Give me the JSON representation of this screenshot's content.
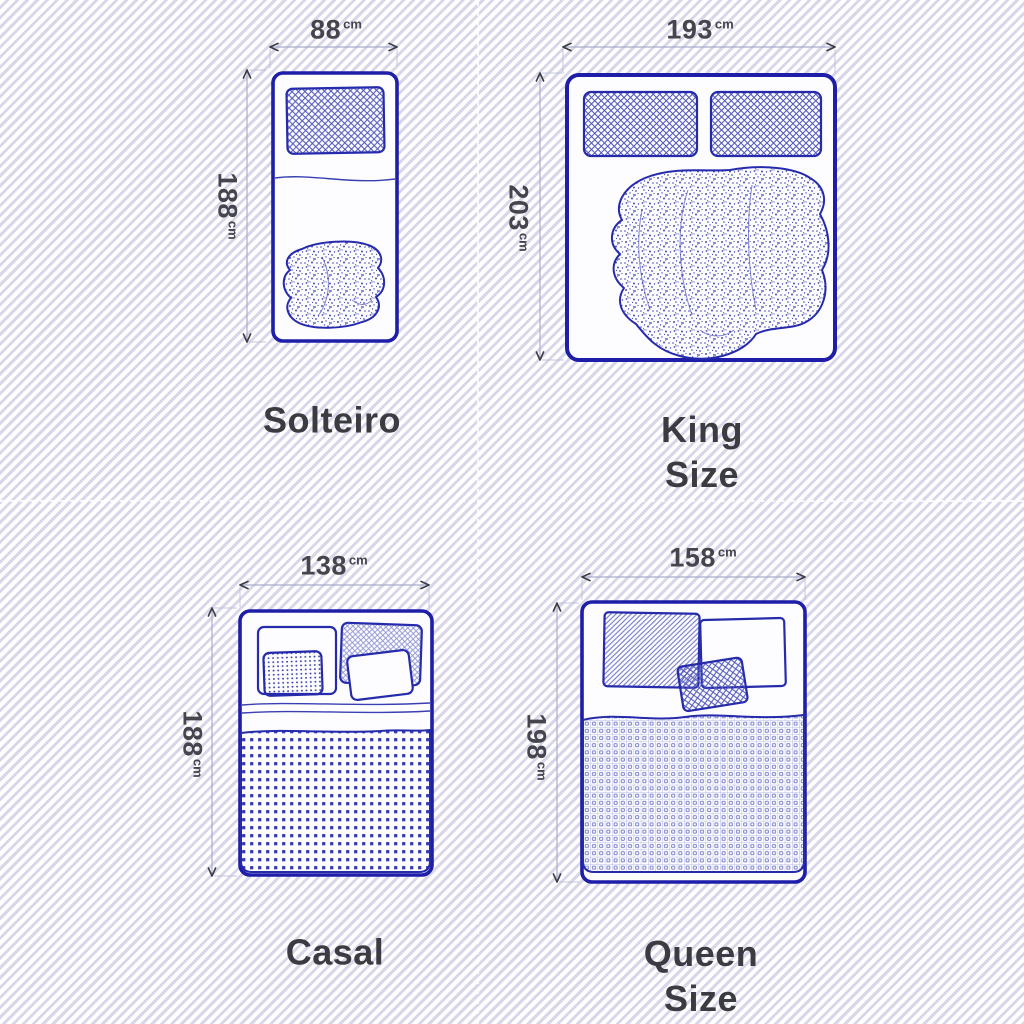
{
  "units": {
    "cm": "cm"
  },
  "beds": {
    "solteiro": {
      "label": "Solteiro",
      "width": "88",
      "length": "188"
    },
    "king": {
      "label": "King\nSize",
      "width": "193",
      "length": "203"
    },
    "casal": {
      "label": "Casal",
      "width": "138",
      "length": "188"
    },
    "queen": {
      "label": "Queen\nSize",
      "width": "158",
      "length": "198"
    }
  },
  "colors": {
    "bed_outline": "#1e1ea9",
    "pattern_blue": "#4f55b8",
    "bed_fill": "#fdfdff",
    "caption_text": "#3b3b42",
    "dimension_text": "#45454e",
    "dimension_line": "#a7adc9",
    "background_stripe": "#d9d6e9"
  }
}
